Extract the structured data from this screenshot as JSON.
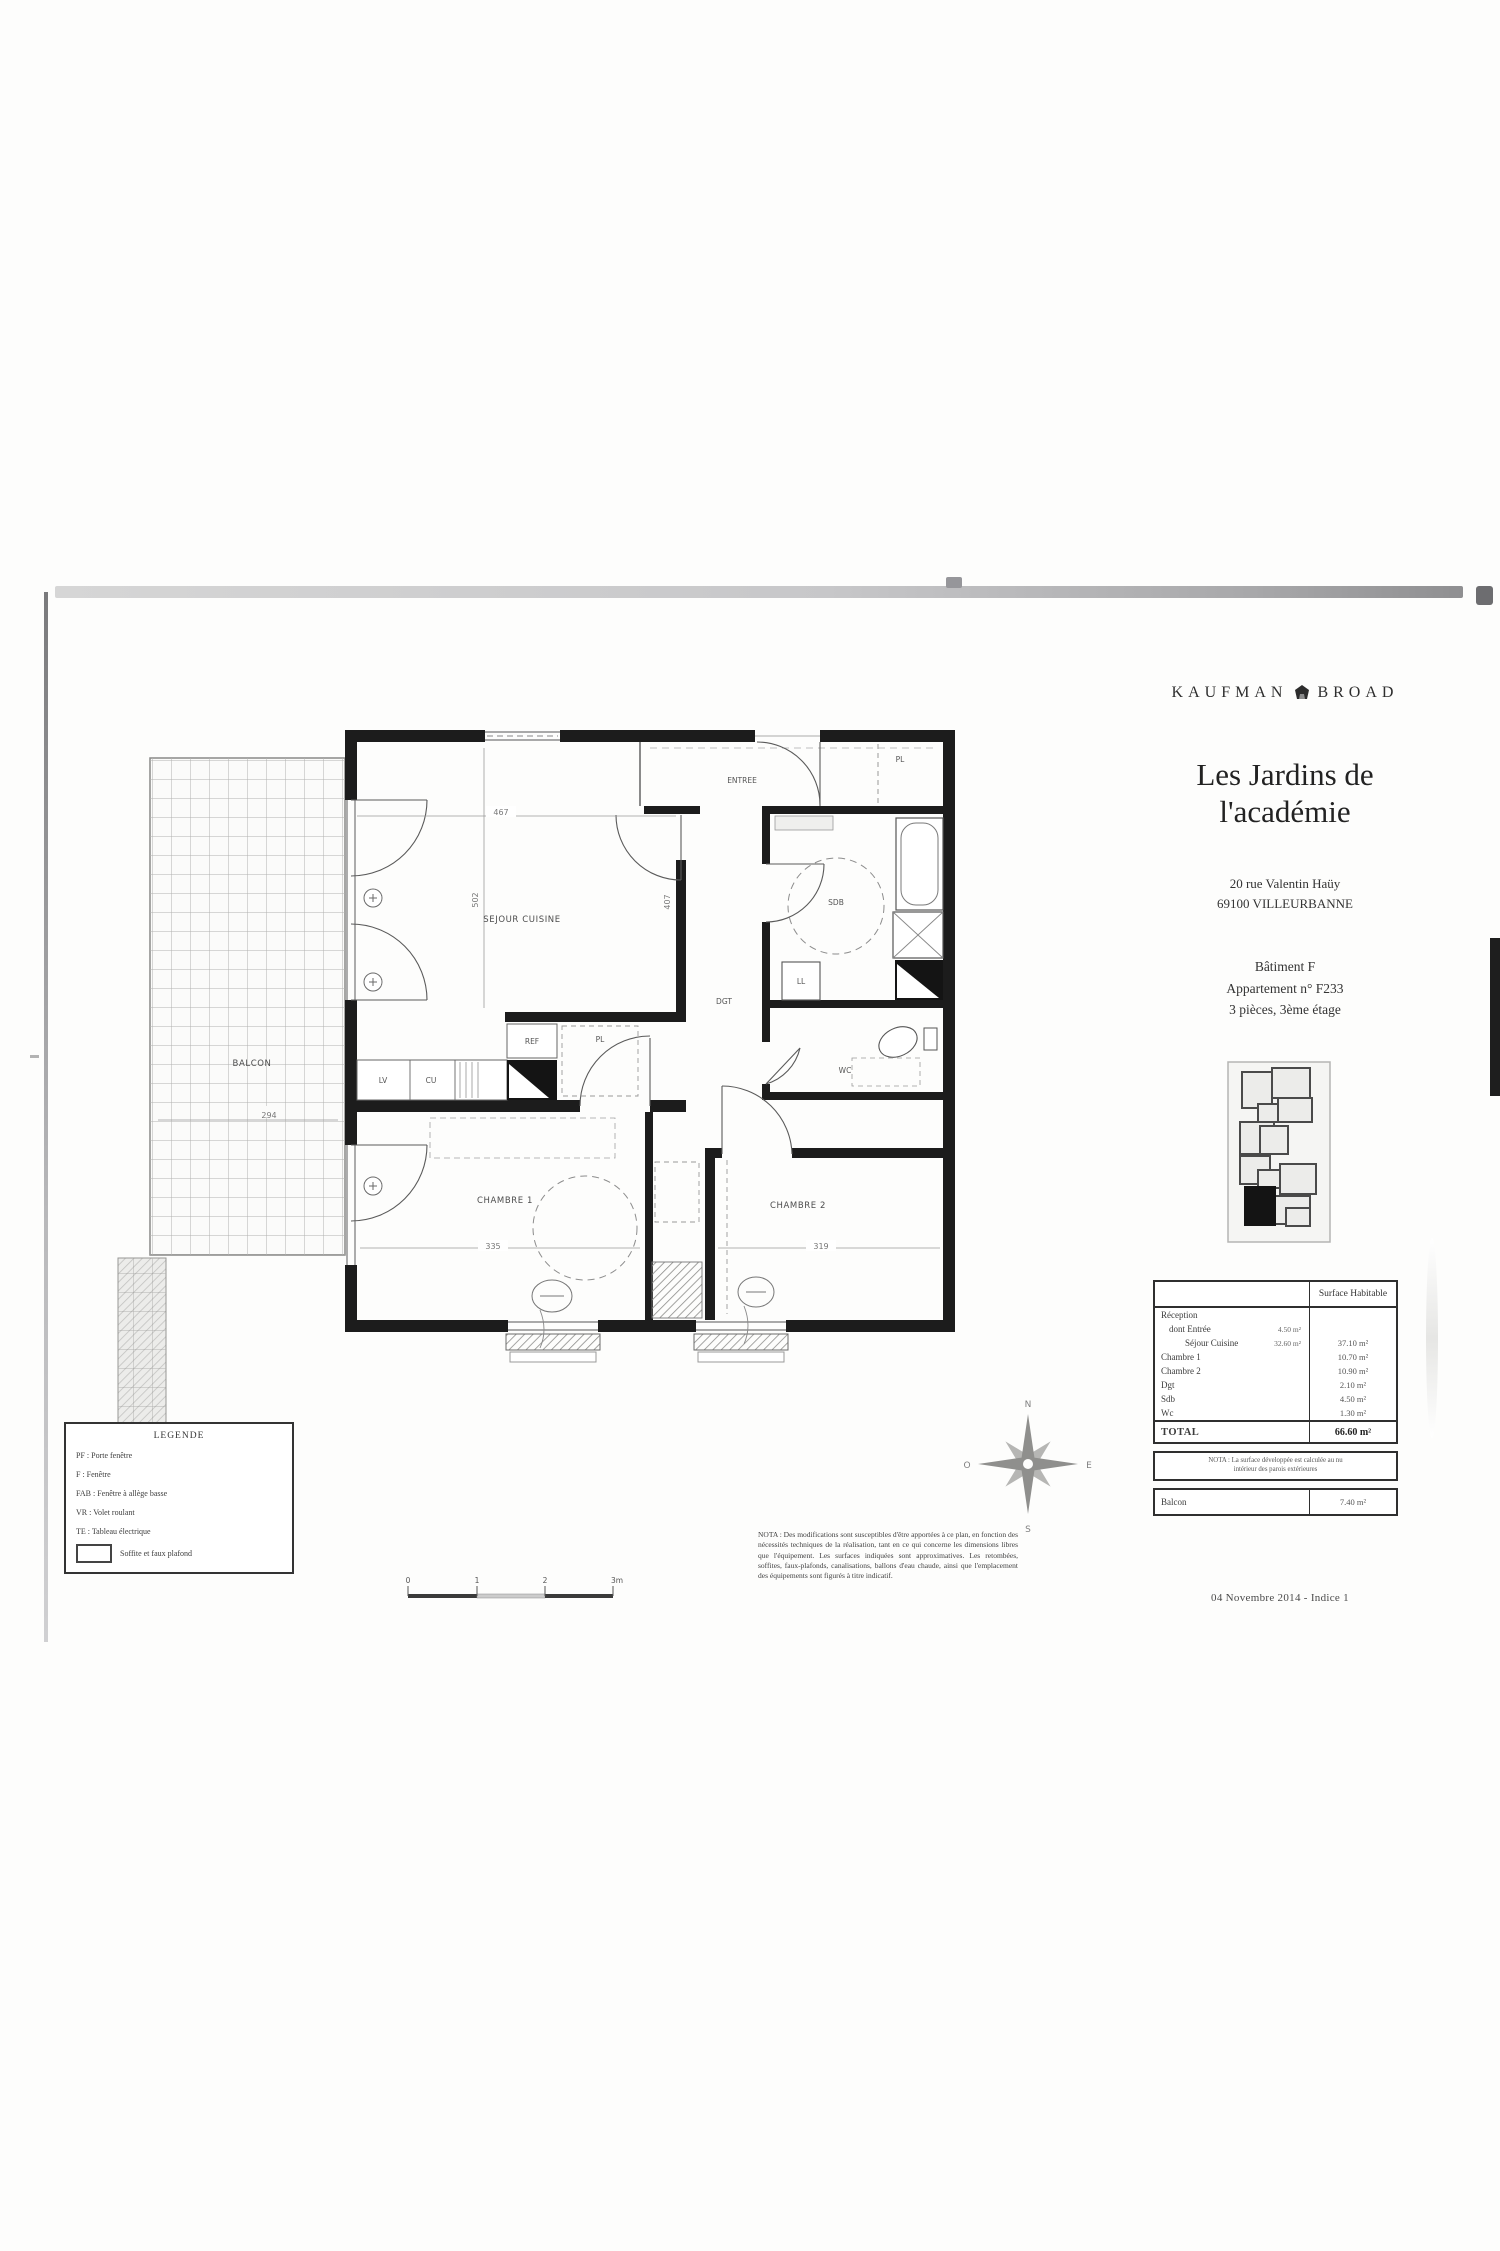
{
  "header": {
    "brand": {
      "left": "KAUFMAN",
      "right": "BROAD"
    },
    "title_line1": "Les Jardins de",
    "title_line2": "l'académie",
    "address_line1": "20 rue Valentin Haüy",
    "address_line2": "69100 VILLEURBANNE",
    "building": "Bâtiment F",
    "apartment": "Appartement n° F233",
    "details": "3 pièces, 3ème étage"
  },
  "plan": {
    "rooms": {
      "sejour": "SEJOUR CUISINE",
      "entree": "ENTREE",
      "sdb": "SDB",
      "wc": "WC",
      "dgt": "DGT",
      "chambre1": "CHAMBRE 1",
      "chambre2": "CHAMBRE 2",
      "balcon": "BALCON"
    },
    "fixtures": {
      "ref": "REF",
      "lv": "LV",
      "cu": "CU",
      "ll": "LL",
      "pl": "PL"
    },
    "dims": {
      "sejour_w": "467",
      "sejour_h": "502",
      "hall_h": "407",
      "balcon_w": "294",
      "ch1_w": "335",
      "ch2_w": "319"
    }
  },
  "compass": {
    "n": "N",
    "s": "S",
    "e": "E",
    "o": "O"
  },
  "scale": {
    "t0": "0",
    "t1": "1",
    "t2": "2",
    "t3": "3m"
  },
  "legend": {
    "title": "LEGENDE",
    "items": [
      "PF : Porte fenêtre",
      "F : Fenêtre",
      "FAB : Fenêtre à allège basse",
      "VR : Volet roulant",
      "TE : Tableau électrique"
    ],
    "soffite": "Soffite et faux plafond"
  },
  "nota": "NOTA : Des modifications sont susceptibles d'être apportées à ce plan, en fonction des nécessités techniques de la réalisation, tant en ce qui concerne les dimensions libres que l'équipement. Les surfaces indiquées sont approximatives. Les retombées, soffites, faux-plafonds, canalisations, ballons d'eau chaude, ainsi que l'emplacement des équipements sont figurés à titre indicatif.",
  "table": {
    "header_value": "Surface Habitable",
    "rows": [
      {
        "label": "Réception",
        "sub": "",
        "value": ""
      },
      {
        "label": "dont   Entrée",
        "sub": "4.50 m²",
        "value": ""
      },
      {
        "label": "Séjour Cuisine",
        "sub": "32.60 m²",
        "value": "37.10 m²"
      },
      {
        "label": "Chambre 1",
        "sub": "",
        "value": "10.70 m²"
      },
      {
        "label": "Chambre 2",
        "sub": "",
        "value": "10.90 m²"
      },
      {
        "label": "Dgt",
        "sub": "",
        "value": "2.10 m²"
      },
      {
        "label": "Sdb",
        "sub": "",
        "value": "4.50 m²"
      },
      {
        "label": "Wc",
        "sub": "",
        "value": "1.30 m²"
      }
    ],
    "total_label": "TOTAL",
    "total_value": "66.60 m²",
    "note_line1": "NOTA : La surface développée est calculée au nu",
    "note_line2": "intérieur des parois extérieures",
    "balcon_label": "Balcon",
    "balcon_value": "7.40 m²"
  },
  "footer": {
    "date": "04 Novembre 2014 - Indice 1"
  }
}
